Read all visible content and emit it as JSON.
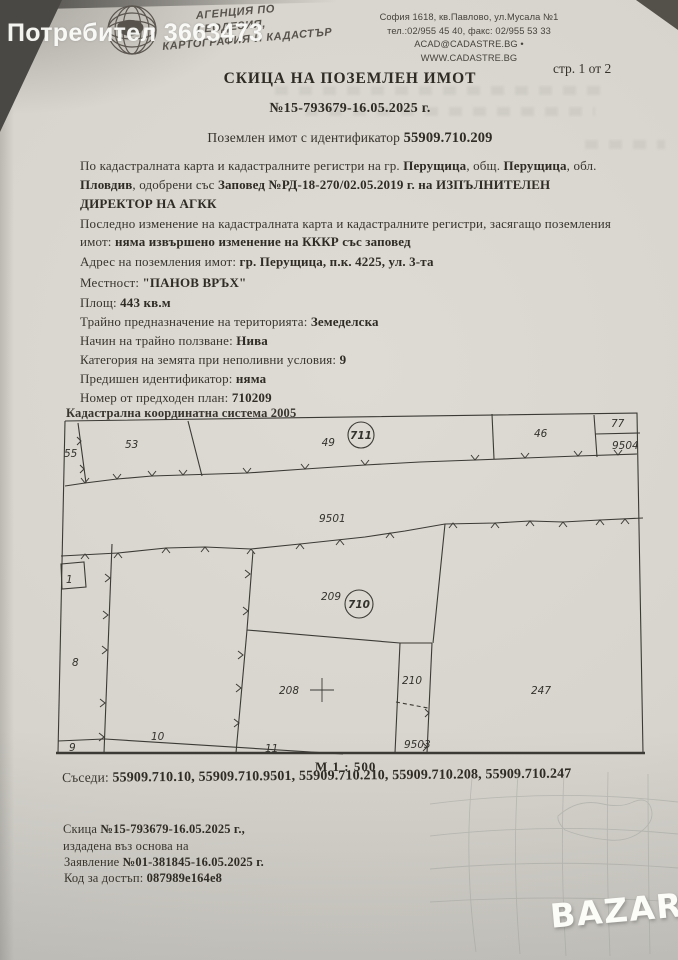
{
  "photo": {
    "watermark_user": "Потребител 3663473",
    "bazar_logo": "BAZAR"
  },
  "header": {
    "agency_name_line1": "АГЕНЦИЯ ПО ГЕОДЕЗИЯ,",
    "agency_name_line2": "КАРТОГРАФИЯ И КАДАСТЪР",
    "address_line1": "София 1618, кв.Павлово, ул.Мусала №1",
    "address_line2": "тел.:02/955 45 40, факс: 02/955 53 33",
    "address_line3": "ACAD@CADASTRE.BG • WWW.CADASTRE.BG",
    "page_indicator": "стр. 1 от 2"
  },
  "document": {
    "title": "СКИЦА НА ПОЗЕМЛЕН ИМОТ",
    "number": "№15-793679-16.05.2025 г.",
    "subtitle_prefix": "Поземлен имот с идентификатор ",
    "subtitle_id": "55909.710.209"
  },
  "body": {
    "lines": [
      {
        "a": "По кадастралната карта и кадастралните регистри на гр. ",
        "b": "Перущица",
        "c": ", общ. ",
        "d": "Перущица",
        "e": ", обл."
      },
      {
        "a": "Пловдив",
        "b": ", одобрени със ",
        "c": "Заповед №РД-18-270/02.05.2019 г. на ИЗПЪЛНИТЕЛЕН"
      },
      {
        "a": "ДИРЕКТОР НА АГКК"
      },
      {
        "a": "Последно изменение на кадастралната карта и кадастралните регистри, засягащо поземления"
      },
      {
        "a": "имот: ",
        "b": "няма извършено изменение на КККР със заповед"
      }
    ],
    "fields": [
      {
        "label": "Адрес на поземления имот: ",
        "value": "гр. Перущица, п.к. 4225, ул. 3-та"
      },
      {
        "label": "Местност: ",
        "value": "\"ПАНОВ ВРЪХ\""
      },
      {
        "label": "Площ: ",
        "value": "443 кв.м"
      },
      {
        "label": "Трайно предназначение на територията: ",
        "value": "Земеделска"
      },
      {
        "label": "Начин на трайно ползване: ",
        "value": "Нива"
      },
      {
        "label": "Категория на земята при неполивни условия: ",
        "value": "9"
      },
      {
        "label": "Предишен идентификатор: ",
        "value": "няма"
      },
      {
        "label": "Номер от предходен план: ",
        "value": "710209"
      }
    ]
  },
  "map": {
    "heading": "Кадастрална координатна система 2005",
    "scale": "М 1 : 500",
    "parcels": {
      "p55": "55",
      "p53": "53",
      "p49": "49",
      "p711": "711",
      "p46": "46",
      "p77": "77",
      "p9504": "9504",
      "p9501": "9501",
      "p1": "1",
      "p8": "8",
      "p209": "209",
      "p710": "710",
      "p9": "9",
      "p10": "10",
      "p11": "11",
      "p208": "208",
      "p210": "210",
      "p9503": "9503",
      "p247": "247"
    }
  },
  "neighbors": {
    "label": "Съседи: ",
    "value": "55909.710.10, 55909.710.9501, 55909.710.210, 55909.710.208, 55909.710.247"
  },
  "footer": {
    "l1_label": "Скица ",
    "l1_value": "№15-793679-16.05.2025 г.,",
    "l2": "издадена въз основа на",
    "l3_label": "Заявление ",
    "l3_value": "№01-381845-16.05.2025 г.",
    "l4_label": "Код за достъп: ",
    "l4_value": "087989e164e8"
  }
}
